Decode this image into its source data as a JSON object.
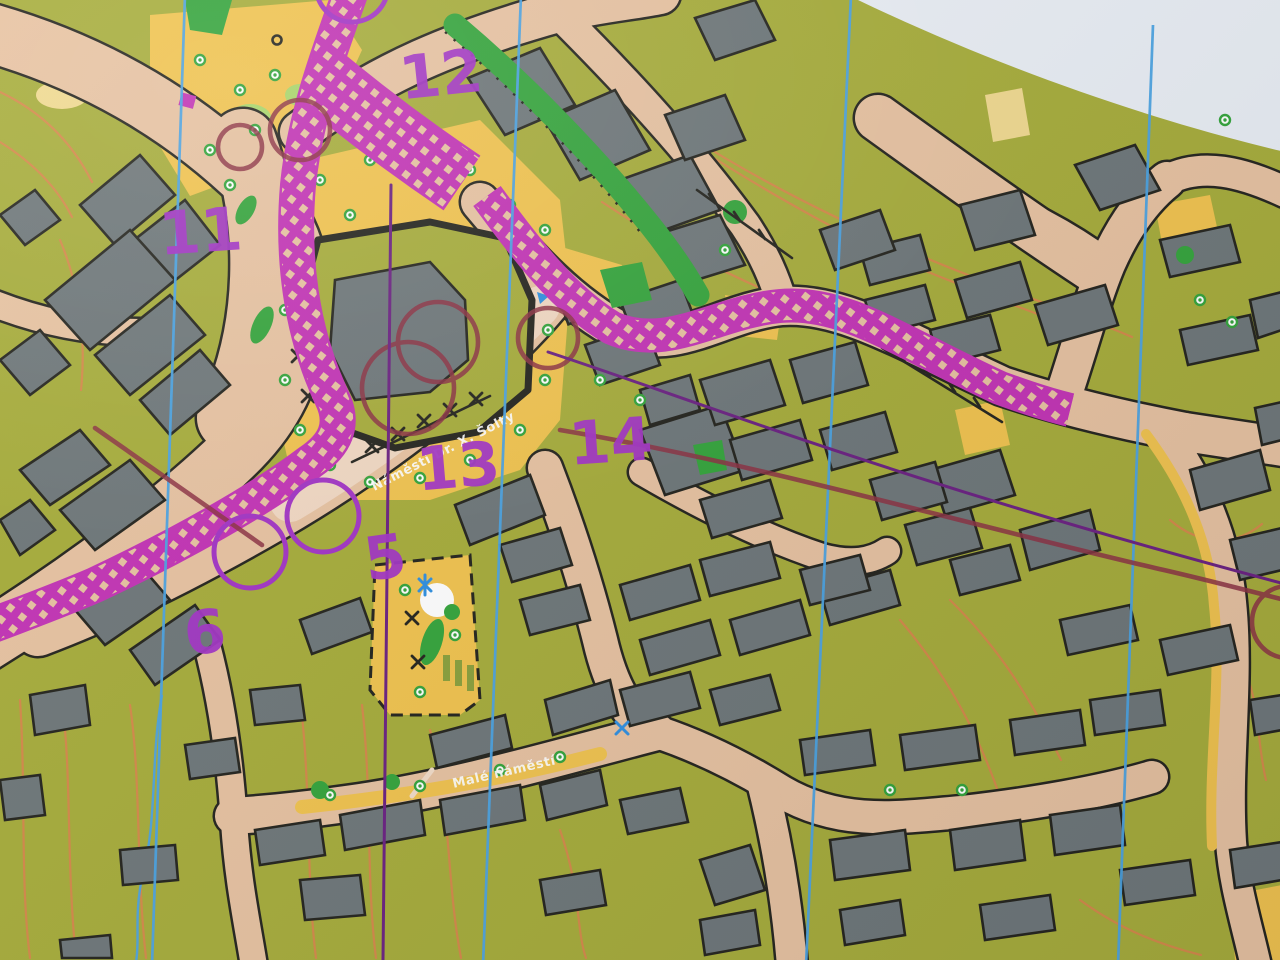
{
  "map": {
    "description": "Photograph of a sprint orienteering map with purple course overprint",
    "street_labels": [
      {
        "text": "Náměstí Dr. X. Šolty"
      },
      {
        "text": "Malé náměstí"
      }
    ],
    "control_numbers": [
      {
        "value": "11"
      },
      {
        "value": "12"
      },
      {
        "value": "13"
      },
      {
        "value": "14"
      },
      {
        "value": "5"
      },
      {
        "value": "6"
      }
    ],
    "colors": {
      "olive": "#a6ac39",
      "paper": "#e9eef4",
      "tan": "#e7c2a0",
      "tanlight": "#f2dcc8",
      "yellow": "#f1c34d",
      "grey": "#6d7678",
      "blk": "#23231c",
      "magenta": "#c232b4",
      "purple": "#a234c4",
      "maroon": "#8c3142",
      "bluen": "#4aa2e2",
      "green": "#33a43a",
      "greenlight": "#a8d668",
      "orange": "#d8854a",
      "white": "#ffffff"
    }
  }
}
